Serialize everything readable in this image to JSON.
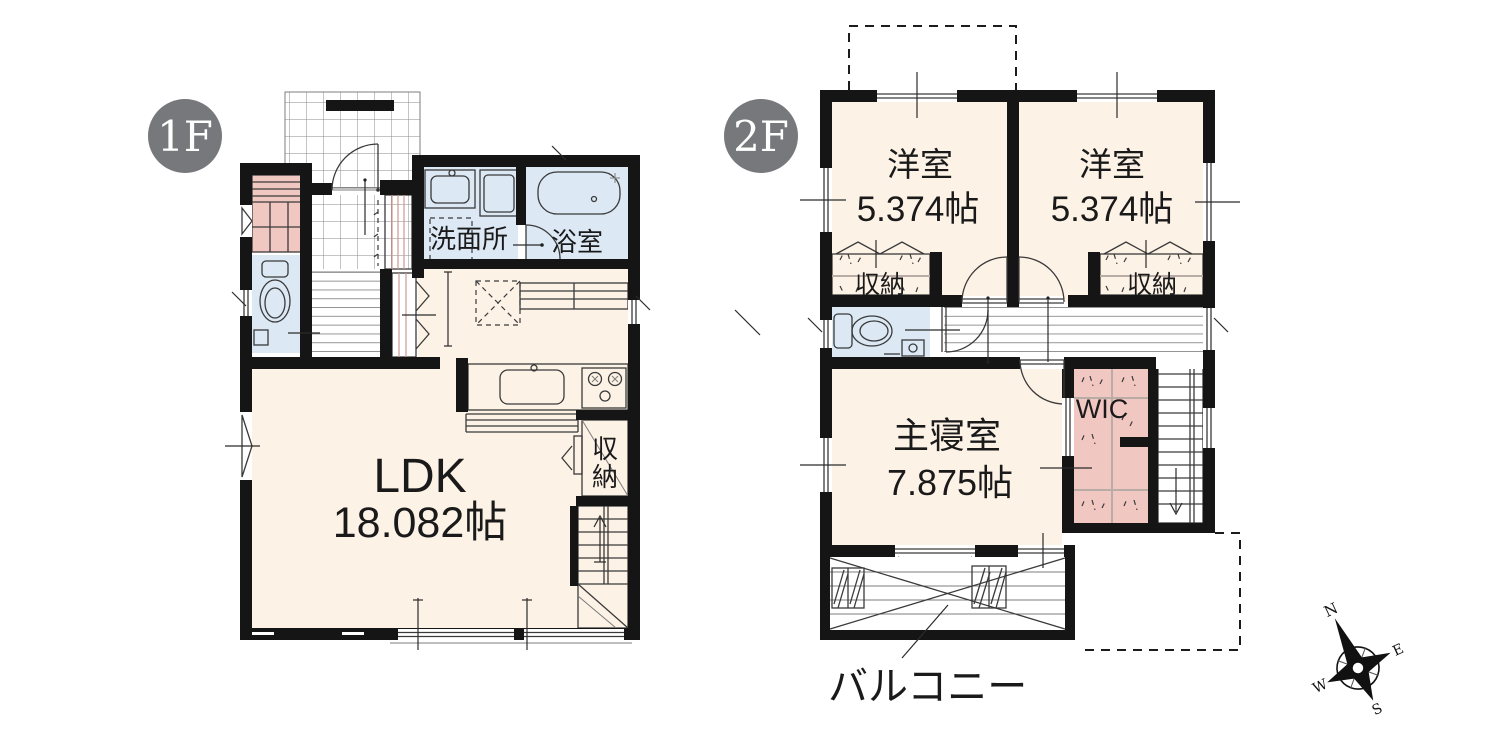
{
  "canvas": {
    "width": 1500,
    "height": 750,
    "background": "#ffffff"
  },
  "palette": {
    "wall": "#151515",
    "floor_cream": "#fdf2e6",
    "wet_area_blue": "#dce9f5",
    "storage_pink": "#f1c7c2",
    "badge_gray": "#77787b",
    "badge_text": "#ffffff",
    "line_dark": "#3a3a3a",
    "text": "#1a1a1a"
  },
  "floors": {
    "f1": {
      "badge": "1F",
      "rooms": {
        "ldk": {
          "name": "LDK",
          "size": "18.082帖"
        },
        "washroom": {
          "name": "洗面所"
        },
        "bath": {
          "name": "浴室"
        },
        "storage": {
          "name": "収納",
          "chars": [
            "収",
            "納"
          ]
        }
      }
    },
    "f2": {
      "badge": "2F",
      "rooms": {
        "western_a": {
          "name": "洋室",
          "size": "5.374帖"
        },
        "western_b": {
          "name": "洋室",
          "size": "5.374帖"
        },
        "closet_a": {
          "name": "収納"
        },
        "closet_b": {
          "name": "収納"
        },
        "master": {
          "name": "主寝室",
          "size": "7.875帖"
        },
        "wic": {
          "name": "WIC"
        },
        "balcony": {
          "name": "バルコニー"
        }
      }
    }
  },
  "compass": {
    "n": "N",
    "e": "E",
    "s": "S",
    "w": "W"
  }
}
